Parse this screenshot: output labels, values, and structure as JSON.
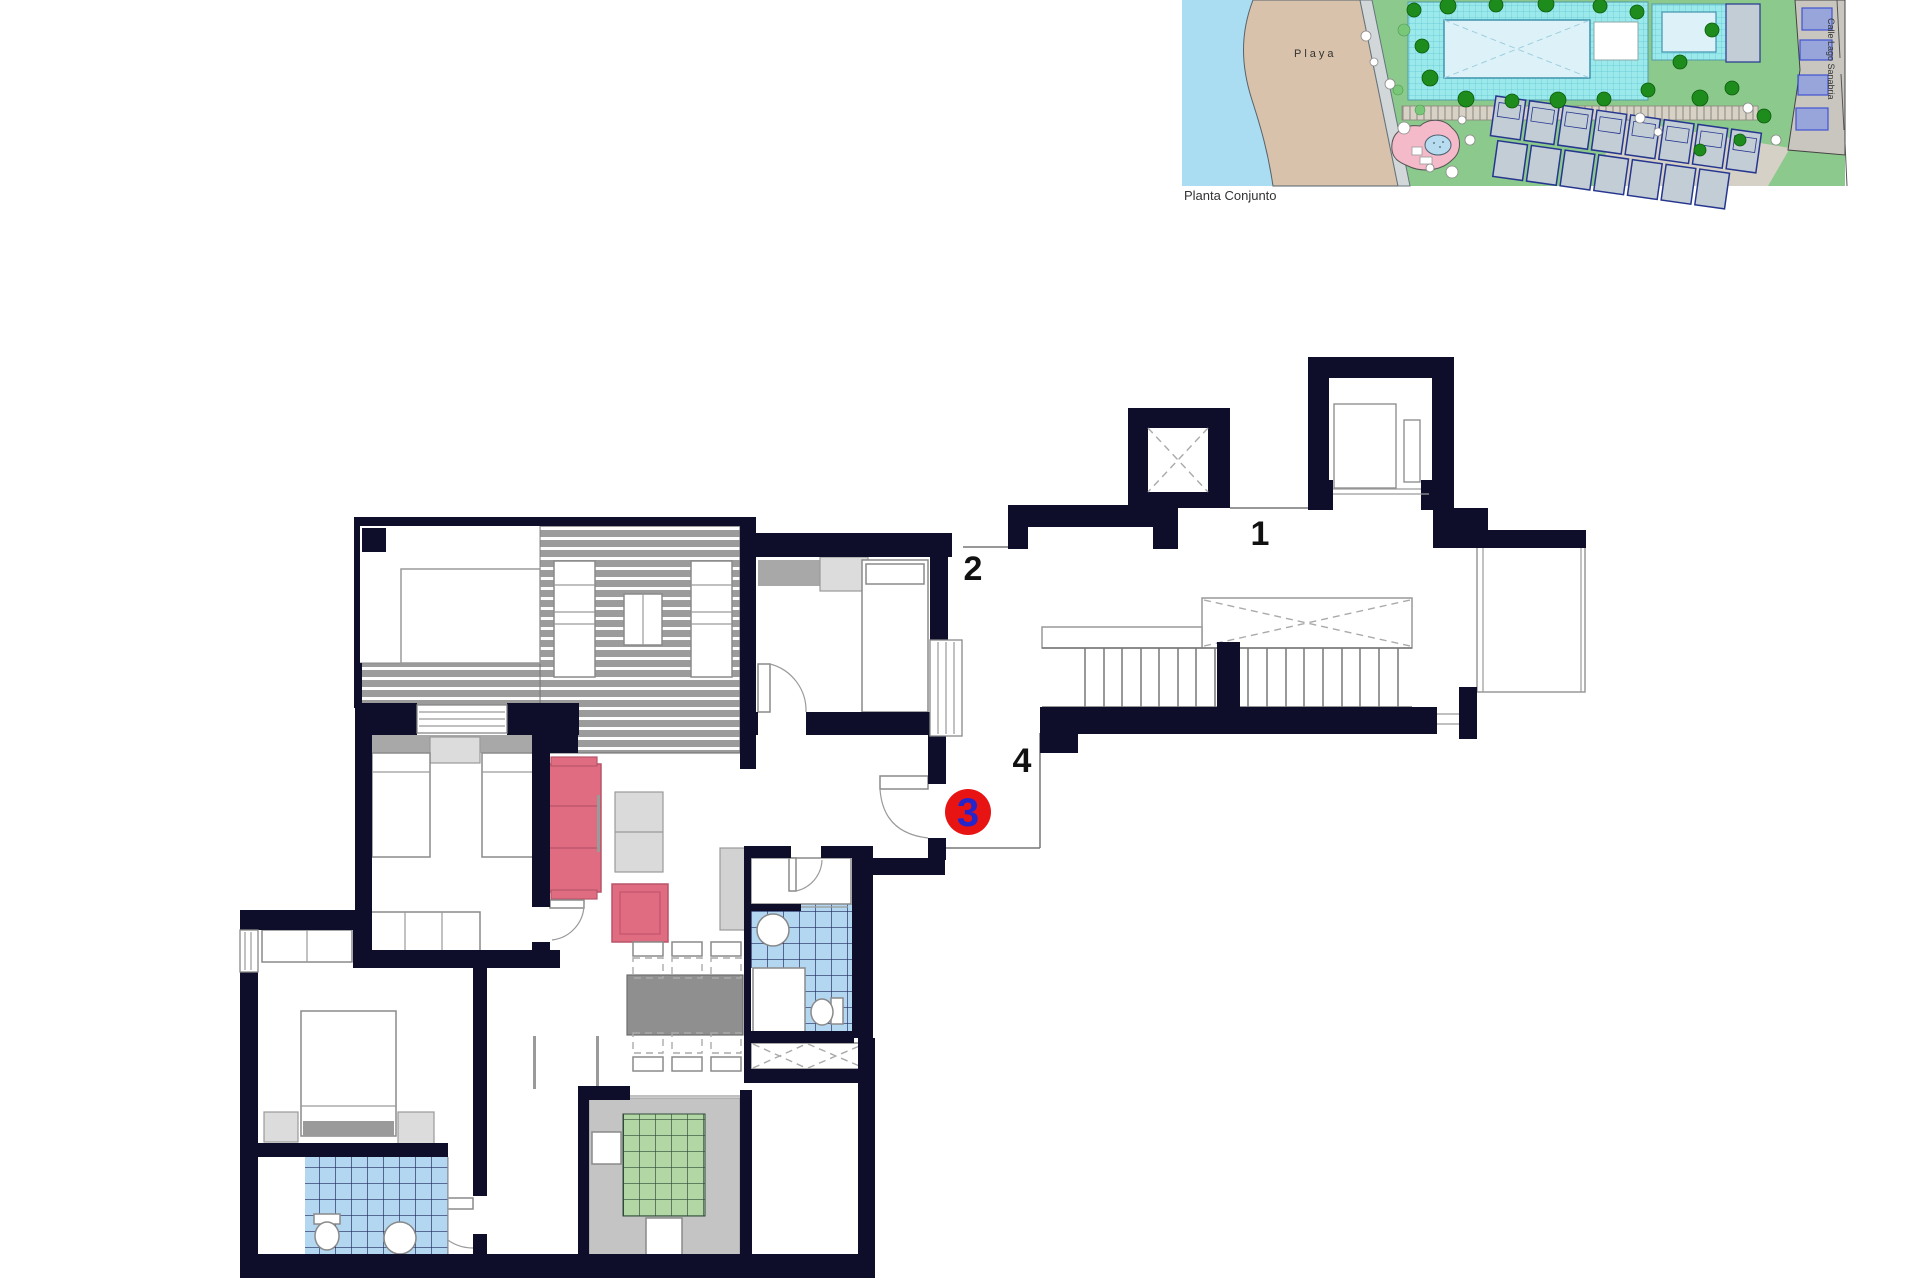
{
  "site_plan": {
    "caption": "Planta Conjunto",
    "beach_label": "Playa",
    "street_label": "Calle Lago Sanabria",
    "colors": {
      "sea": "#aadcf2",
      "sand": "#d8c2ab",
      "lawn": "#8cc98c",
      "pool_deck": "#9ce9ec",
      "pool_water": "#ddf2f8",
      "playground_pink": "#f4bac9",
      "building_fill": "#c3cdd6",
      "building_outline": "#26368f",
      "tree_green": "#1d8c1d"
    }
  },
  "floor_plan": {
    "landing_labels": {
      "one": "1",
      "two": "2",
      "four": "4"
    },
    "unit_marker": {
      "number": "3",
      "circle_color": "#e81414",
      "number_color": "#2525cc"
    },
    "colors": {
      "wall": "#0e0e2a",
      "sofa_pink": "#e06c82",
      "bath_tile_blue": "#b3d7f0",
      "kitchen_tile_green": "#b2d6a4",
      "deck_grey": "#9b9b9b",
      "dining_table_grey": "#8f8f8f",
      "headboard_grey": "#a8a8a8"
    }
  }
}
